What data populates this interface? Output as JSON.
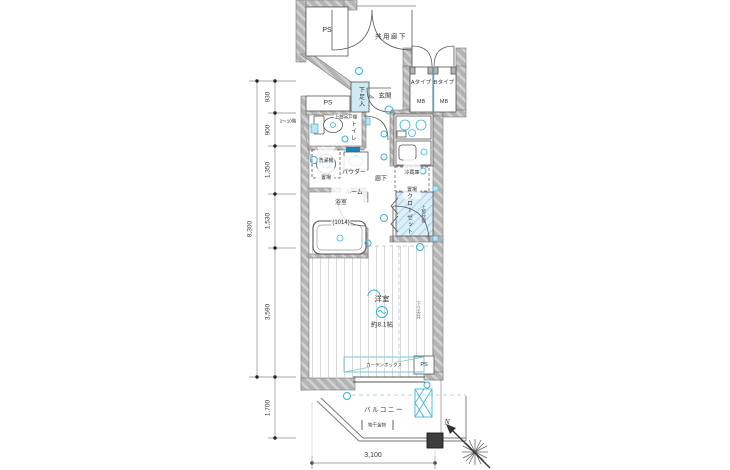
{
  "colors": {
    "accent": "#35b3d6",
    "wall_gray": "#b4b4b4",
    "closet_fill": "#ddeff9",
    "line_dark": "#555555"
  },
  "labels": {
    "ps_top": "PS",
    "common_corridor": "共用廊下",
    "mb_a_line1": "Aタイプ",
    "mb_a_line2": "MB",
    "mb_b_line1": "Bタイプ",
    "mb_b_line2": "MB",
    "ps_mid": "PS",
    "shoe_cabinet": "下足入",
    "entrance": "玄関",
    "toilet": "トイレ",
    "upper_cabinet": "上部吊戸棚",
    "washer_line1": "洗濯機",
    "washer_line2": "置場",
    "powder_line1": "パウダー",
    "powder_line2": "ルーム",
    "corridor": "廊下",
    "bath_line1": "浴室",
    "bath_line2": "(1014)",
    "fridge_line1": "冷蔵庫",
    "fridge_line2": "置場",
    "closet": "クローゼット",
    "closet_shelf": "上部枕棚",
    "room": "洋室",
    "room_size": "約8.1帖",
    "dropped_ceiling": "下り天井",
    "curtain_box": "カーテンボックス",
    "ps_bottom": "PS",
    "balcony": "バルコニー",
    "laundry_bracket": "物干金物",
    "floor_range": "2〜10階",
    "compass_north": "N"
  },
  "dimensions": {
    "left_total": "8,300",
    "left_segments": [
      "930",
      "900",
      "1,350",
      "1,530",
      "3,590",
      "1,700"
    ],
    "bottom_width": "3,100"
  }
}
